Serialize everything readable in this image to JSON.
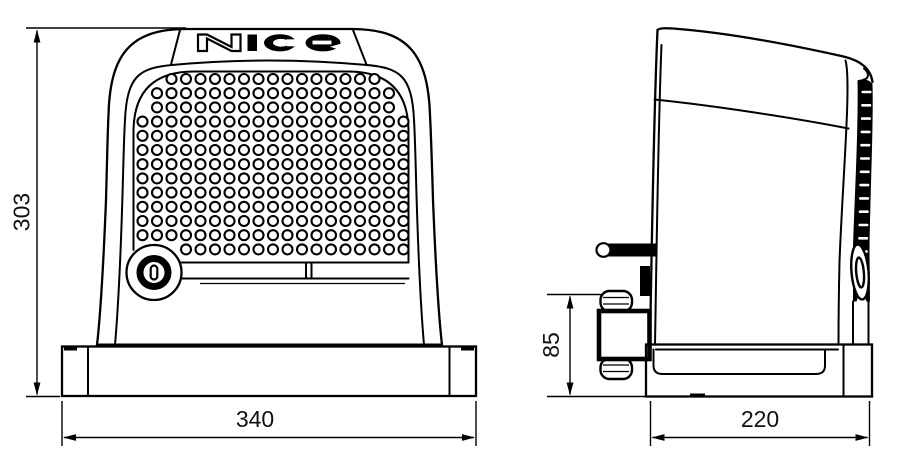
{
  "logo": {
    "text": "Nice"
  },
  "dimensions": {
    "height": {
      "value": "303"
    },
    "width": {
      "value": "340"
    },
    "depth": {
      "value": "220"
    },
    "bracket": {
      "value": "85"
    }
  },
  "grille": {
    "rows": 13,
    "cols": 19,
    "hole_radius": 5
  },
  "rib_strip": {
    "dash_count": 16
  },
  "colors": {
    "line": "#000000",
    "background": "#ffffff",
    "text": "#111111"
  }
}
